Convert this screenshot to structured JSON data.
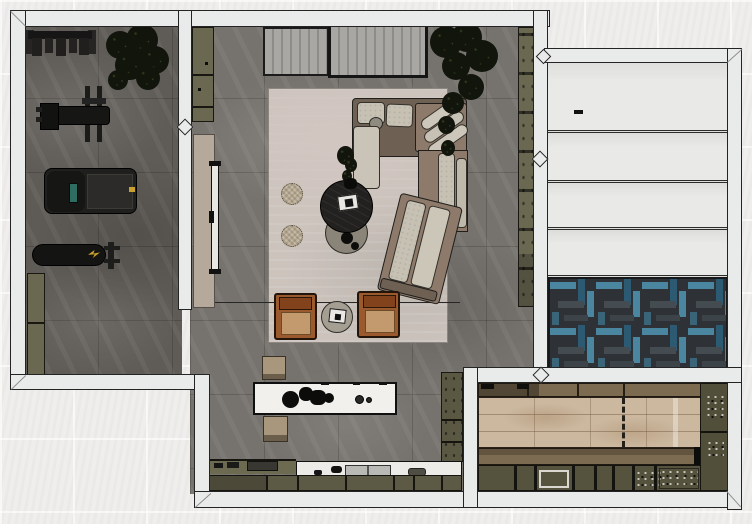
{
  "view": {
    "type": "top-down-rendered-floor-plan",
    "width_px": 752,
    "height_px": 524,
    "description": "Orthographic top view render of an interior: home gym, lounge with sectional sofa, kitchen with island, staircase hall with herringbone runner, and a rear utility room with wood platform and cabinetry"
  },
  "palette": {
    "wall": "#e9ebea",
    "wall_outline": "#242424",
    "background": "#efeeec",
    "gym_floor": "#5f5b56",
    "living_floor": "#76726d",
    "rug": "#cbc3bc",
    "rug_tint": "#d2c6c1",
    "olive_cabinet": "#6b6852",
    "olive_dark": "#55523e",
    "tan_door": "#b4a99b",
    "sofa_frame": "#6e6154",
    "sofa_corner": "#8d7a6b",
    "cushion": "#c7c1b4",
    "armchair": "#9a5a2d",
    "armchair_back": "#82431c",
    "armchair_seat": "#c29a6d",
    "table_black": "#232120",
    "table_gray": "#8b8478",
    "pouf": "#c8bba4",
    "island_top": "#f1f0ed",
    "marble": "#edebe7",
    "wood_light": "#cbb89f",
    "wood_band": "#7d6b51",
    "stairs": "#e9e9e7",
    "herringbone_base": "#2e3236",
    "herringbone_teal": "#4a86a0",
    "herringbone_teal_dark": "#2d5a73",
    "herringbone_gray": "#454c51",
    "plant": "#11150c",
    "equipment": "#1c1c1b",
    "accent_yellow": "#c8a22a",
    "treadmill_screen": "#2e6e62",
    "steel": "#b9b9b5"
  },
  "rooms": [
    {
      "id": "gym",
      "label": "home gym",
      "furniture": [
        {
          "id": "dumbbell-rack",
          "label": "dumbbell storage rack"
        },
        {
          "id": "weight-machine",
          "label": "bench press with barbell and weight stack"
        },
        {
          "id": "treadmill",
          "label": "treadmill with console screen"
        },
        {
          "id": "exercise-bench",
          "label": "flat exercise bench"
        },
        {
          "id": "gym-cabinet",
          "label": "low storage cabinet"
        },
        {
          "id": "gym-plant",
          "label": "potted plant"
        }
      ]
    },
    {
      "id": "living-room",
      "label": "lounge",
      "furniture": [
        {
          "id": "slat-panel-fixed",
          "label": "slatted wardrobe front"
        },
        {
          "id": "slat-panel-sliding",
          "label": "framed slatted sliding door"
        },
        {
          "id": "media-wall",
          "label": "TV media wall panel"
        },
        {
          "id": "tv",
          "label": "wall-mounted TV"
        },
        {
          "id": "tall-cabinet-top",
          "label": "tall cabinet"
        },
        {
          "id": "shelf-right",
          "label": "tall shelving strip"
        },
        {
          "id": "area-rug",
          "label": "area rug"
        },
        {
          "id": "sectional-sofa",
          "label": "corner sectional sofa with chaise and angled end"
        },
        {
          "id": "coffee-table-black",
          "label": "round black coffee table with book and vase"
        },
        {
          "id": "coffee-table-gray",
          "label": "round gray nesting coffee table"
        },
        {
          "id": "pouf",
          "label": "round knitted pouf",
          "count": 2
        },
        {
          "id": "leather-armchair",
          "label": "cognac leather armchair",
          "count": 2
        },
        {
          "id": "side-table",
          "label": "round side table with book"
        },
        {
          "id": "living-plant",
          "label": "large potted plant"
        }
      ]
    },
    {
      "id": "kitchen",
      "label": "kitchen",
      "furniture": [
        {
          "id": "island",
          "label": "marble island with hob and decor"
        },
        {
          "id": "stool",
          "label": "upholstered stool",
          "count": 2
        },
        {
          "id": "counter-sink",
          "label": "marble counter with sink and faucet"
        },
        {
          "id": "counter-hob",
          "label": "olive counter with cooktop"
        },
        {
          "id": "kitchen-tall-cabinet",
          "label": "tall cabinet column"
        }
      ]
    },
    {
      "id": "stair-hall",
      "label": "staircase hall",
      "furniture": [
        {
          "id": "staircase",
          "label": "white staircase treads",
          "tread_count": 4
        },
        {
          "id": "herringbone-carpet",
          "label": "teal herringbone carpet"
        }
      ]
    },
    {
      "id": "utility-room",
      "label": "rear utility room",
      "furniture": [
        {
          "id": "wood-platform",
          "label": "light wood platform with dashed centerline"
        },
        {
          "id": "utility-cabinets",
          "label": "cabinet run with sink"
        },
        {
          "id": "utility-column",
          "label": "storage column"
        }
      ]
    }
  ]
}
